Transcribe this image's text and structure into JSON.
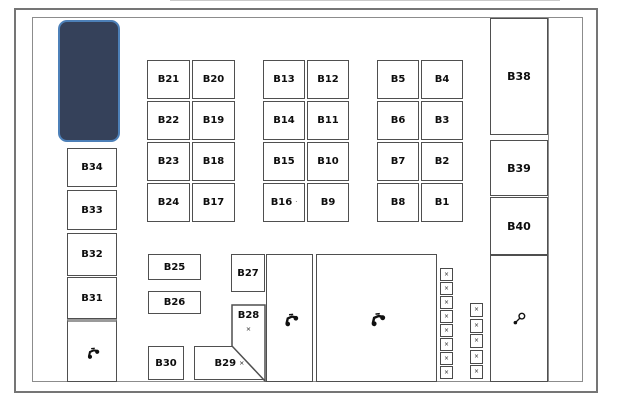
{
  "map": {
    "highlight": {
      "fill": "#35415a",
      "border": "#4d80b8"
    },
    "left_stalls": [
      "B34",
      "B33",
      "B32",
      "B31"
    ],
    "grid_west": {
      "rows": [
        [
          "B21",
          "B20"
        ],
        [
          "B22",
          "B19"
        ],
        [
          "B23",
          "B18"
        ],
        [
          "B24",
          "B17"
        ]
      ]
    },
    "grid_center": {
      "rows": [
        [
          "B13",
          "B12"
        ],
        [
          "B14",
          "B11"
        ],
        [
          "B15",
          "B10"
        ],
        [
          "B16",
          "B9"
        ]
      ],
      "b16_mark": "·"
    },
    "grid_east": {
      "rows": [
        [
          "B5",
          "B4"
        ],
        [
          "B6",
          "B3"
        ],
        [
          "B7",
          "B2"
        ],
        [
          "B8",
          "B1"
        ]
      ]
    },
    "right_stalls": [
      "B38",
      "B39",
      "B40"
    ],
    "bottom_stalls": {
      "b25": "B25",
      "b26": "B26",
      "b27": "B27",
      "b28": "B28",
      "b29": "B29",
      "b30": "B30"
    },
    "marks": {
      "b28": "×",
      "b29": "×"
    },
    "mini_mark": "×",
    "icons": {
      "left_bay": "motorcycle-icon",
      "center_corridor": "motorcycle-icon",
      "large_bay": "motorcycle-icon",
      "right_bay": "key-icon"
    }
  }
}
